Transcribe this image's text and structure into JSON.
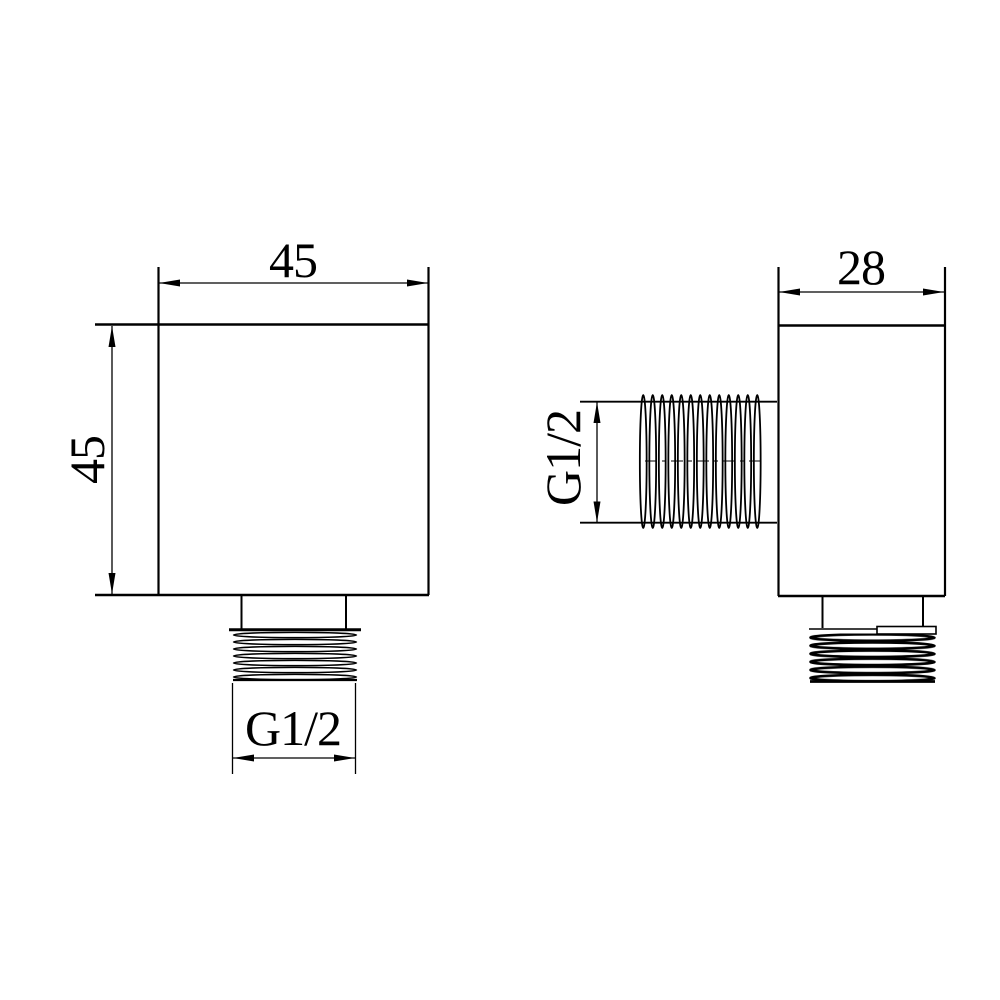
{
  "page": {
    "background": "#ffffff"
  },
  "drawing": {
    "kind": "technical-drawing-two-views",
    "line_color": "#000000",
    "views": {
      "front": {
        "width_label": "45",
        "height_label": "45",
        "outlet_thread_label": "G1/2"
      },
      "side": {
        "depth_label": "28",
        "inlet_thread_label": "G1/2"
      }
    }
  }
}
